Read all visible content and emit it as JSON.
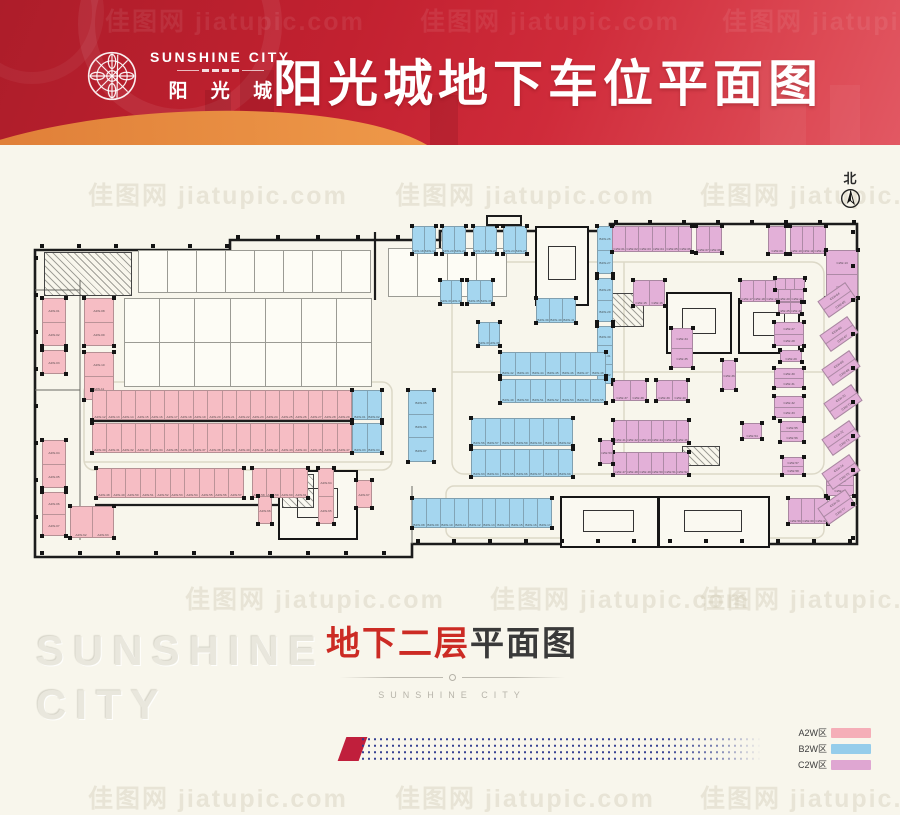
{
  "header": {
    "brand_en": "SUNSHINE CITY",
    "brand_zh": "阳 光 城",
    "title": "阳光城地下车位平面图"
  },
  "compass": {
    "label": "北"
  },
  "watermark": {
    "text": "佳图网 jiatupic.com"
  },
  "ghost": {
    "line1": "SUNSHINE",
    "line2": "CITY"
  },
  "caption": {
    "highlight": "地下二层",
    "rest": "平面图",
    "subtitle": "SUNSHINE CITY"
  },
  "legend": {
    "items": [
      {
        "label": "A2W区",
        "color": "#f5aeb8"
      },
      {
        "label": "B2W区",
        "color": "#95cdeb"
      },
      {
        "label": "C2W区",
        "color": "#dfa6d2"
      }
    ]
  },
  "floor_plan": {
    "zone_colors": {
      "A2W": "#f6bdc4",
      "B2W": "#a5d6ef",
      "C2W": "#e3b0d8"
    },
    "cluster_format": "x,y,w,h,zone,stalls,orientation(h=side-by-side,v=stacked),rotation",
    "clusters": [
      [
        42,
        298,
        24,
        48,
        "A2W",
        2,
        "v"
      ],
      [
        42,
        350,
        24,
        24,
        "A2W",
        1,
        "v"
      ],
      [
        42,
        440,
        24,
        48,
        "A2W",
        2,
        "v"
      ],
      [
        42,
        492,
        24,
        44,
        "A2W",
        2,
        "v"
      ],
      [
        84,
        298,
        30,
        48,
        "A2W",
        2,
        "v"
      ],
      [
        84,
        352,
        30,
        48,
        "A2W",
        2,
        "v"
      ],
      [
        92,
        390,
        260,
        30,
        "A2W",
        18,
        "h"
      ],
      [
        92,
        423,
        260,
        30,
        "A2W",
        18,
        "h"
      ],
      [
        96,
        468,
        148,
        30,
        "A2W",
        10,
        "h"
      ],
      [
        252,
        468,
        56,
        30,
        "A2W",
        4,
        "h"
      ],
      [
        70,
        506,
        44,
        32,
        "A2W",
        2,
        "h"
      ],
      [
        318,
        468,
        16,
        56,
        "A2W",
        2,
        "v"
      ],
      [
        258,
        496,
        14,
        28,
        "A2W",
        1,
        "v"
      ],
      [
        356,
        480,
        16,
        28,
        "A2W",
        1,
        "v"
      ],
      [
        352,
        390,
        30,
        30,
        "B2W",
        2,
        "h"
      ],
      [
        352,
        423,
        30,
        30,
        "B2W",
        2,
        "h"
      ],
      [
        408,
        390,
        26,
        72,
        "B2W",
        3,
        "v"
      ],
      [
        412,
        498,
        140,
        30,
        "B2W",
        10,
        "h"
      ],
      [
        412,
        226,
        24,
        28,
        "B2W",
        2,
        "h"
      ],
      [
        442,
        226,
        24,
        28,
        "B2W",
        2,
        "h"
      ],
      [
        473,
        226,
        24,
        28,
        "B2W",
        2,
        "h"
      ],
      [
        503,
        226,
        24,
        28,
        "B2W",
        2,
        "h"
      ],
      [
        597,
        226,
        16,
        48,
        "B2W",
        2,
        "v"
      ],
      [
        597,
        278,
        16,
        44,
        "B2W",
        2,
        "v"
      ],
      [
        597,
        326,
        16,
        58,
        "B2W",
        3,
        "v"
      ],
      [
        440,
        280,
        22,
        24,
        "B2W",
        2,
        "h"
      ],
      [
        467,
        280,
        26,
        24,
        "B2W",
        2,
        "h"
      ],
      [
        478,
        322,
        22,
        24,
        "B2W",
        2,
        "h"
      ],
      [
        536,
        298,
        40,
        25,
        "B2W",
        3,
        "h"
      ],
      [
        500,
        352,
        106,
        24,
        "B2W",
        7,
        "h"
      ],
      [
        500,
        379,
        106,
        24,
        "B2W",
        7,
        "h"
      ],
      [
        471,
        418,
        102,
        28,
        "B2W",
        7,
        "h"
      ],
      [
        471,
        449,
        102,
        28,
        "B2W",
        7,
        "h"
      ],
      [
        612,
        226,
        80,
        26,
        "C2W",
        6,
        "h"
      ],
      [
        696,
        226,
        26,
        27,
        "C2W",
        2,
        "h"
      ],
      [
        768,
        226,
        18,
        28,
        "C2W",
        1,
        "h"
      ],
      [
        790,
        226,
        36,
        28,
        "C2W",
        3,
        "h"
      ],
      [
        826,
        250,
        32,
        48,
        "C2W",
        2,
        "v"
      ],
      [
        633,
        280,
        32,
        26,
        "C2W",
        2,
        "h"
      ],
      [
        740,
        280,
        64,
        22,
        "C2W",
        5,
        "h"
      ],
      [
        775,
        278,
        30,
        12,
        "C2W",
        3,
        "h"
      ],
      [
        778,
        302,
        24,
        12,
        "C2W",
        2,
        "h"
      ],
      [
        774,
        322,
        30,
        24,
        "C2W",
        2,
        "v"
      ],
      [
        780,
        350,
        22,
        12,
        "C2W",
        1,
        "h"
      ],
      [
        774,
        368,
        30,
        20,
        "C2W",
        2,
        "v"
      ],
      [
        774,
        396,
        30,
        22,
        "C2W",
        2,
        "v"
      ],
      [
        671,
        328,
        22,
        40,
        "C2W",
        2,
        "v"
      ],
      [
        722,
        360,
        14,
        30,
        "C2W",
        1,
        "v"
      ],
      [
        613,
        380,
        34,
        21,
        "C2W",
        2,
        "h"
      ],
      [
        656,
        380,
        32,
        21,
        "C2W",
        2,
        "h"
      ],
      [
        613,
        420,
        76,
        23,
        "C2W",
        6,
        "h"
      ],
      [
        613,
        452,
        76,
        23,
        "C2W",
        6,
        "h"
      ],
      [
        600,
        440,
        13,
        24,
        "C2W",
        1,
        "v"
      ],
      [
        742,
        423,
        20,
        16,
        "C2W",
        1,
        "h"
      ],
      [
        780,
        421,
        24,
        21,
        "C2W",
        2,
        "v"
      ],
      [
        782,
        457,
        22,
        18,
        "C2W",
        2,
        "v"
      ],
      [
        788,
        498,
        40,
        26,
        "C2W",
        3,
        "h"
      ],
      [
        826,
        474,
        28,
        22,
        "C2W",
        2,
        "v"
      ],
      [
        820,
        290,
        34,
        20,
        "C2W",
        2,
        "v",
        -35
      ],
      [
        822,
        324,
        34,
        20,
        "C2W",
        2,
        "v",
        -35
      ],
      [
        824,
        358,
        34,
        20,
        "C2W",
        2,
        "v",
        -35
      ],
      [
        826,
        392,
        34,
        20,
        "C2W",
        2,
        "v",
        -35
      ],
      [
        824,
        428,
        34,
        20,
        "C2W",
        2,
        "v",
        -35
      ],
      [
        824,
        462,
        34,
        20,
        "C2W",
        2,
        "v",
        -35
      ],
      [
        820,
        497,
        34,
        20,
        "C2W",
        2,
        "v",
        -35
      ]
    ],
    "cores": [
      [
        535,
        226,
        50,
        76
      ],
      [
        666,
        292,
        62,
        58
      ],
      [
        738,
        298,
        58,
        52
      ],
      [
        278,
        470,
        76,
        66
      ],
      [
        560,
        496,
        95,
        48
      ],
      [
        658,
        496,
        108,
        48
      ]
    ],
    "hatched": [
      [
        44,
        252,
        86,
        42
      ],
      [
        612,
        293,
        30,
        32
      ],
      [
        282,
        474,
        30,
        32
      ],
      [
        682,
        446,
        36,
        18
      ]
    ],
    "storage_grids": [
      [
        138,
        250,
        232,
        42,
        8,
        1
      ],
      [
        124,
        298,
        248,
        88,
        7,
        2
      ],
      [
        388,
        248,
        118,
        48,
        4,
        1
      ]
    ]
  }
}
